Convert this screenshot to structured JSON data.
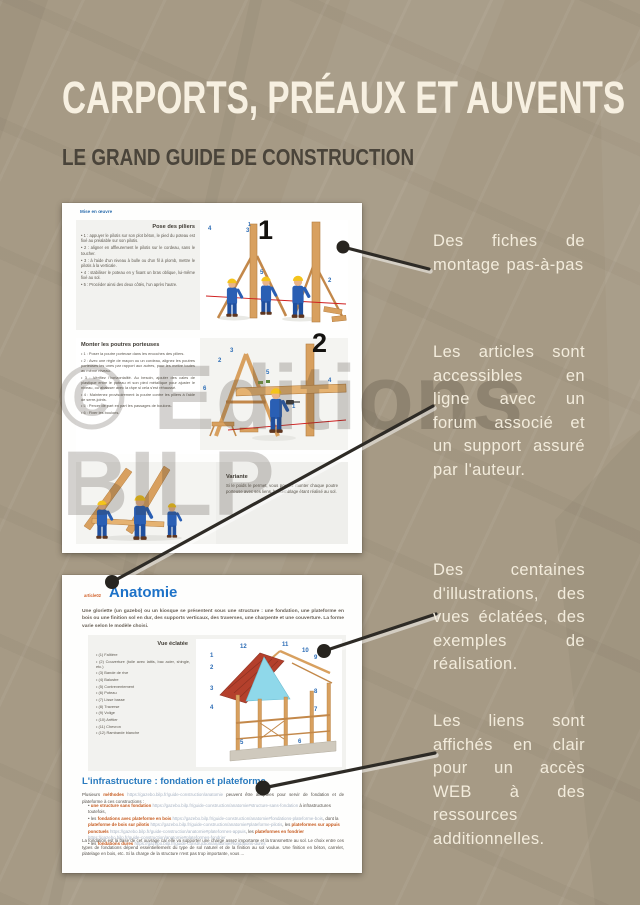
{
  "header": {
    "title": "CARPORTS, PRÉAUX ET AUVENTS",
    "subtitle": "LE GRAND GUIDE DE CONSTRUCTION"
  },
  "watermark": {
    "line1": "© Editions",
    "line2": "BILP"
  },
  "colors": {
    "background": "#a69a85",
    "title_text": "#f7f0e1",
    "subtitle_text": "#4a443a",
    "annotation_text": "#f3ecdc",
    "connector_line": "#2e2b26",
    "doc_heading_blue": "#1d72c8",
    "doc_link_orange": "#c65a1e",
    "doc_url_gray": "#a9b4c4",
    "callout_number_blue": "#2d6db6",
    "illustration_wood": "#d8a05f",
    "illustration_worker_blue": "#2a5fb4",
    "illustration_roof_red": "#b4402c",
    "illustration_tarp_cyan": "#8fd8ea"
  },
  "annotations": [
    {
      "text": "Des fiches de montage pas-à-pas"
    },
    {
      "text": "Les articles sont accessibles en ligne avec un forum associé et un support assuré par l'auteur."
    },
    {
      "text": "Des centaines d'illustrations, des vues éclatées, des exemples de réalisation."
    },
    {
      "text": "Les liens sont affichés en clair pour un accès WEB à des ressources additionnelles."
    }
  ],
  "doc1": {
    "top_link": "Mise en œuvre",
    "step1": {
      "heading": "Pose des piliers",
      "figure_number": "1",
      "figure_number_small": "1",
      "bullets": [
        "1 : appuyer le pilotis sur son plot béton, le pied du poteau est fixé au préalable sur son pilotis.",
        "2 : aligner en affleurement le pilotis sur le cordeau, sans le toucher.",
        "3 : à l'aide d'un niveau à bulle ou d'un fil à plomb, mettre le pilotis à la verticale.",
        "4 : stabiliser le poteau en y fixant un bras oblique, lui-même fixé au sol.",
        "5 : Procéder ainsi des deux côtés, l'un après l'autre."
      ],
      "callouts": [
        "4",
        "3",
        "5",
        "2"
      ]
    },
    "step2": {
      "heading": "Monter les poutres porteuses",
      "figure_number": "2",
      "bullets": [
        "1 : Poser la poutre porteuse dans les encoches des piliers.",
        "2 : Avec une règle de maçon ou un cordeau, alignez les poutres porteuses les unes par rapport aux autres, pour les mettre toutes au même niveau.",
        "3 : Vérifiez l'horizontalité. Au besoin, ajouter des cales de plastique entre le poteau et son pied métallique pour ajuster le niveau, ou abaisser avec la râpe si cela s'est réhaussé.",
        "4 : Maintenez provisoirement la poutre contre les piliers à l'aide de serre-joints.",
        "5 : Percer de part en part les passages de boulons.",
        "6 : Fixer les boulons."
      ],
      "callouts": [
        "2",
        "3",
        "5",
        "4",
        "6",
        "1"
      ]
    },
    "variante": {
      "heading": "Variante",
      "text": "Si le poids le permet, vous pouvez monter chaque poutre porteuse avec ses liens, l'assemblage étant réalisé au sol."
    }
  },
  "doc2": {
    "article_tag": "article02",
    "heading": "Anatomie",
    "intro": "Une gloriette (un gazebo) ou un kiosque se présentent sous une structure : une fondation, une plateforme en bois ou une finition sol en dur, des supports verticaux, des traverses, une charpente et une couverture. La forme varie selon le modèle choisi.",
    "exploded": {
      "heading": "Vue éclatée",
      "items": [
        "(1) Faîtière",
        "(2) Couverture (toile avec lattis, bac acier, shingle, etc.)",
        "(3) Bande de rive",
        "(4) Balustre",
        "(5) Contreventement",
        "(6) Poteau",
        "(7) Lisse basse",
        "(8) Traverse",
        "(9) Volige",
        "(10) Arêtier",
        "(11) Chevron",
        "(12) Rambarde blanche"
      ],
      "numbers": [
        "1",
        "2",
        "3",
        "4",
        "5",
        "6",
        "7",
        "8",
        "9",
        "10",
        "11",
        "12"
      ]
    },
    "infra": {
      "heading": "L'infrastructure : fondation et plateforme",
      "intro": {
        "lead": "Plusieurs ",
        "link": "méthodes",
        "url": " https://gazebo.bilp.fr/guide-construction/anatomie ",
        "rest": " peuvent être adoptées pour servir de fondation et de plateforme à ces constructions :"
      },
      "bullet1": {
        "link": "une structure sans fondation",
        "url": " https://gazebo.bilp.fr/guide-construction/anatomie#structure-sans-fondation",
        "rest": " à infrastructures toutefois,"
      },
      "bullet2": {
        "pre": "les ",
        "link1": "fondations avec plateforme en bois",
        "url1": " https://gazebo.bilp.fr/guide-construction/anatomie#fondations-plateforme-bois",
        "mid1": ", dont la ",
        "link2": "plateforme de bois sur pilotis",
        "url2": " https://gazebo.bilp.fr/guide-construction/anatomie#plateforme-pilotis",
        "mid2": ", les ",
        "link3": "plateformes sur appuis ponctuels",
        "url3": " https://gazebo.bilp.fr/guide-construction/anatomie#plateformes-appuis",
        "mid3": ", les ",
        "link4": "plateformes en fondrier",
        "url4": " https://gazebo.bilp.fr/guide-construction/anatomie#plateformes-fondrier"
      },
      "bullet3": {
        "pre": "les ",
        "link": "fondations dures",
        "url": " https://gazebo.bilp.fr/guide-construction/anatomie#fondations-dures"
      },
      "footer": "La fondation est la base de cet ouvrage car elle va supporter une charge assez importante et la transmettre au sol. Le choix entre ces types de fondations dépend essentiellement du type de sol naturel et de la finition au sol voulue. Une finition en béton, carrelet, platelage en bois, etc. Si la charge de la structure n'est pas trop importante, vous ..."
    }
  }
}
